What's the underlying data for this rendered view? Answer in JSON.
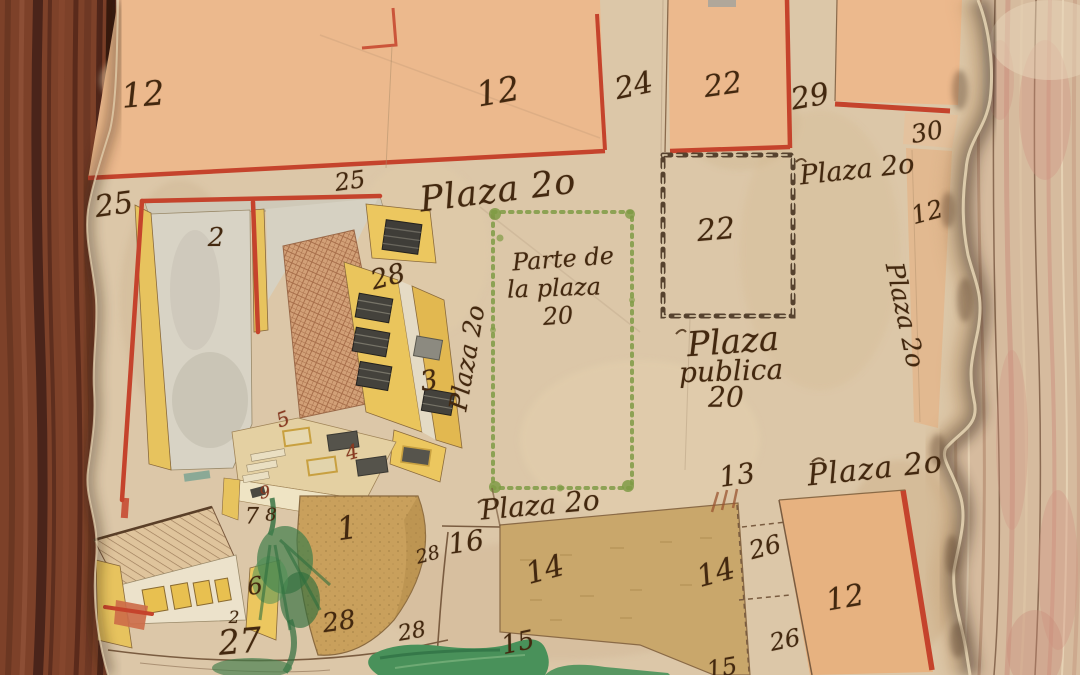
{
  "labels": [
    {
      "name": "parcel-12-top-left",
      "text": "12"
    },
    {
      "name": "parcel-12-top-center",
      "text": "12"
    },
    {
      "name": "parcel-24",
      "text": "24"
    },
    {
      "name": "parcel-22-top",
      "text": "22"
    },
    {
      "name": "parcel-29",
      "text": "29"
    },
    {
      "name": "parcel-30",
      "text": "30"
    },
    {
      "name": "plaza-20-top-right",
      "text": "Plaza 2o"
    },
    {
      "name": "parcel-12-right-strip",
      "text": "12"
    },
    {
      "name": "plaza-20-right-vertical",
      "text": "Plaza 2o"
    },
    {
      "name": "parcel-25-top",
      "text": "25"
    },
    {
      "name": "plaza-20-main",
      "text": "Plaza 2o"
    },
    {
      "name": "parcel-25-left",
      "text": "25"
    },
    {
      "name": "parcel-2-courtyard",
      "text": "2"
    },
    {
      "name": "parcel-28-building",
      "text": "28"
    },
    {
      "name": "parte-de-la-plaza-line1",
      "text": "Parte de"
    },
    {
      "name": "parte-de-la-plaza-line2",
      "text": "la plaza"
    },
    {
      "name": "parte-de-la-plaza-line3",
      "text": "20"
    },
    {
      "name": "plaza-20-left-vertical",
      "text": "Plaza 2o"
    },
    {
      "name": "parcel-22-chained",
      "text": "22"
    },
    {
      "name": "plaza-publica-line1",
      "text": "Plaza"
    },
    {
      "name": "plaza-publica-line2",
      "text": "publica"
    },
    {
      "name": "plaza-publica-line3",
      "text": "20"
    },
    {
      "name": "parcel-3",
      "text": "3"
    },
    {
      "name": "label-5-terrace",
      "text": "5"
    },
    {
      "name": "label-4-terrace",
      "text": "4"
    },
    {
      "name": "label-9-stairs",
      "text": "9"
    },
    {
      "name": "label-7-stairs",
      "text": "7"
    },
    {
      "name": "label-8-stairs",
      "text": "8"
    },
    {
      "name": "label-1-mound",
      "text": "1"
    },
    {
      "name": "parcel-16",
      "text": "16"
    },
    {
      "name": "label-28-small-a",
      "text": "28"
    },
    {
      "name": "parcel-13",
      "text": "13"
    },
    {
      "name": "plaza-20-bottom-right",
      "text": "Plaza 2o"
    },
    {
      "name": "parcel-26-upper",
      "text": "26"
    },
    {
      "name": "parcel-14-left",
      "text": "14"
    },
    {
      "name": "parcel-14-right",
      "text": "14"
    },
    {
      "name": "plaza-20-bottom-center",
      "text": "Plaza 2o"
    },
    {
      "name": "label-6-house",
      "text": "6"
    },
    {
      "name": "label-2-small",
      "text": "2"
    },
    {
      "name": "parcel-27",
      "text": "27"
    },
    {
      "name": "label-28-street-a",
      "text": "28"
    },
    {
      "name": "label-28-street-b",
      "text": "28"
    },
    {
      "name": "parcel-15",
      "text": "15"
    },
    {
      "name": "parcel-12-bottom-right",
      "text": "12"
    },
    {
      "name": "parcel-26-lower",
      "text": "26"
    },
    {
      "name": "parcel-15-bottom",
      "text": "15"
    }
  ],
  "colors": {
    "red_border": "#c5432c",
    "salmon_parcel": "#ebb98d",
    "field_tan": "#c9a76b",
    "building_yellow": "#ecc75f",
    "pond_green": "#49915a",
    "green_dotted_border": "#7f9b45",
    "ink": "#43280f",
    "wood_frame": "#7d4129",
    "wood_surface": "#d6bb9e",
    "parchment": "#dcc7a8"
  }
}
